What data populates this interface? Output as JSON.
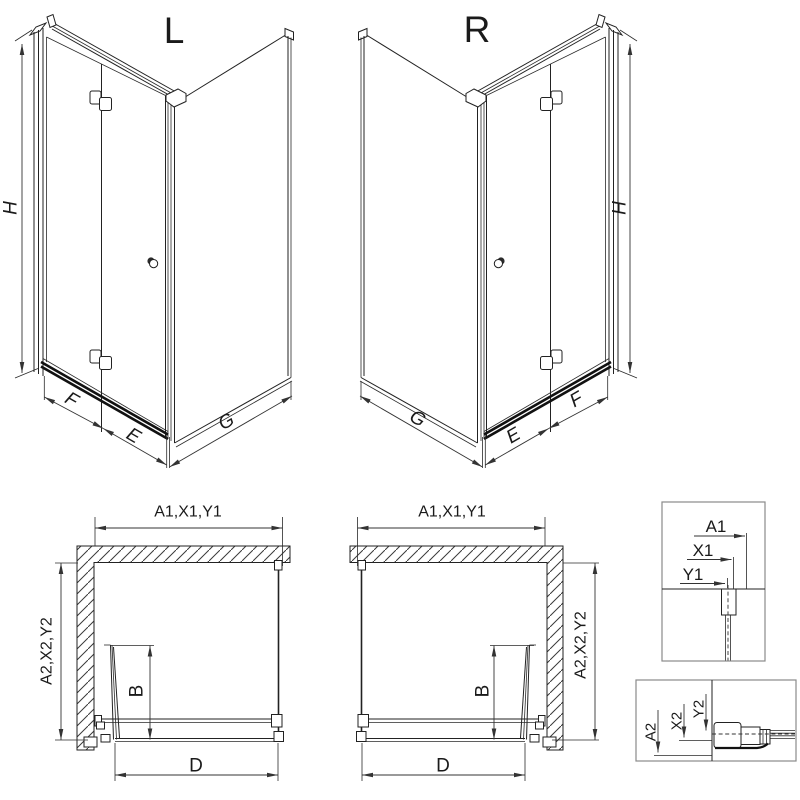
{
  "page": {
    "background": "#ffffff",
    "ink": "#222222",
    "dim_line_color": "#333333",
    "detail_box_border": "#8a8a8a"
  },
  "views": {
    "l3d": {
      "title": "L",
      "h": "H",
      "f": "F",
      "e": "E",
      "g": "G"
    },
    "r3d": {
      "title": "R",
      "h": "H",
      "f": "F",
      "e": "E",
      "g": "G"
    },
    "plan_l": {
      "width": "A1,X1,Y1",
      "depth": "A2,X2,Y2",
      "b": "B",
      "d": "D"
    },
    "plan_r": {
      "width": "A1,X1,Y1",
      "depth": "A2,X2,Y2",
      "b": "B",
      "d": "D"
    },
    "detail_w": {
      "a1": "A1",
      "x1": "X1",
      "y1": "Y1"
    },
    "detail_d": {
      "a2": "A2",
      "x2": "X2",
      "y2": "Y2"
    }
  }
}
